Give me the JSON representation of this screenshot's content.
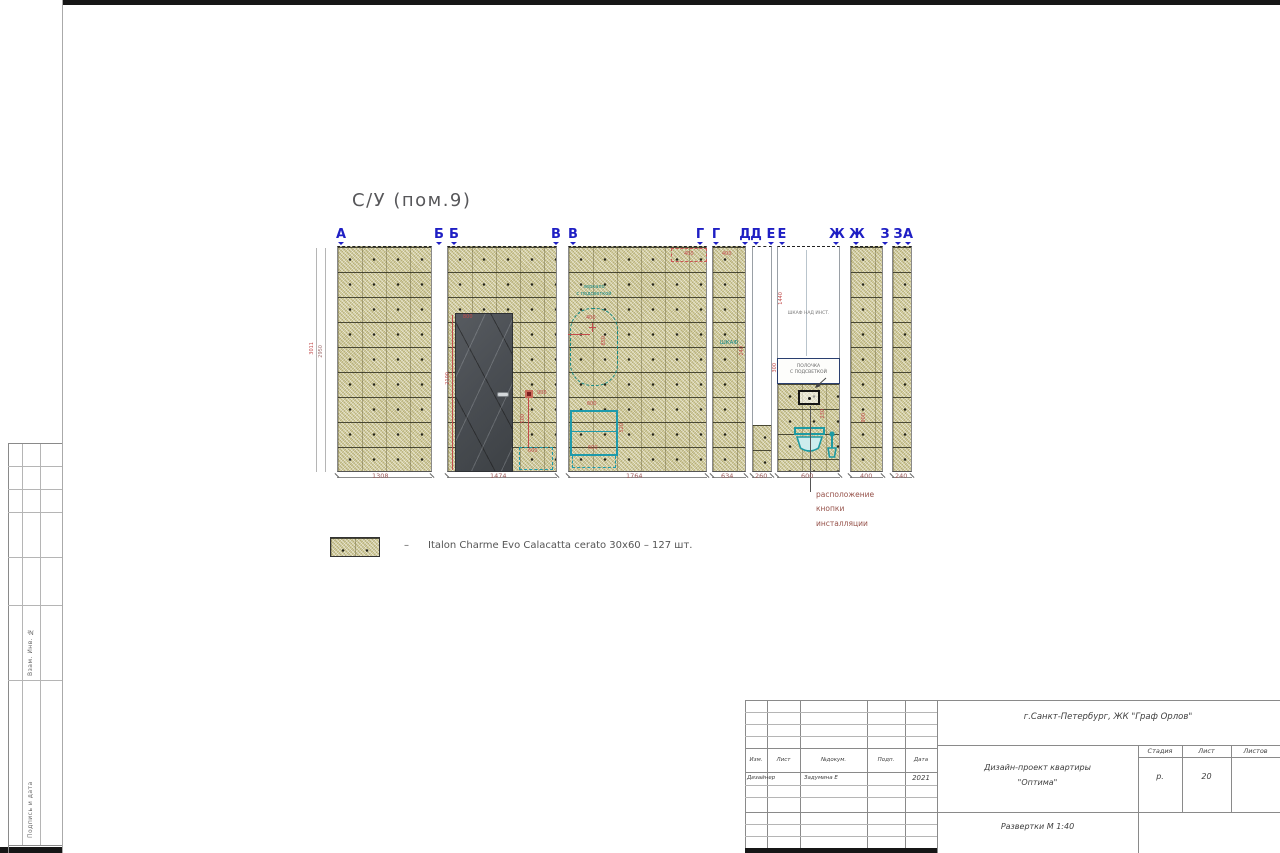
{
  "drawing": {
    "room_title": "С/У (пом.9)",
    "axis_labels": [
      "А",
      "Б",
      "Б",
      "В",
      "В",
      "Г",
      "Г",
      "Д",
      "Д",
      "Е",
      "Е",
      "Ж",
      "Ж",
      "З",
      "З",
      "А"
    ],
    "bottom_dims": [
      "1308",
      "1474",
      "1764",
      "634",
      "260",
      "600",
      "400",
      "240"
    ],
    "height_dims": {
      "outer": "3011",
      "inner": "2950"
    },
    "red_dims": {
      "door_top": "800",
      "door_h": "2100",
      "switch": "900",
      "niche_w": "600",
      "niche_h": "500",
      "mirror_w": "400",
      "mirror_h": "850",
      "cab_top": "600",
      "cab_h": "520",
      "cab_w": "600",
      "vv_top": "400",
      "gg_top": "400",
      "gg_side": "240",
      "inst_h": "1440",
      "shelf_h": "300",
      "btn_h": "230",
      "wall_j": "900"
    },
    "annotations": {
      "mirror_l1": "зеркало",
      "mirror_l2": "с подсветкой",
      "wardrobe": "ШКАФ",
      "inst_cab": "ШКАФ НАД ИНСТ.",
      "shelf_l1": "ПОЛОЧКА",
      "shelf_l2": "С ПОДСВЕТКОЙ",
      "flush_l1": "расположение",
      "flush_l2": "кнопки",
      "flush_l3": "инсталляции"
    }
  },
  "legend": {
    "dash": "–",
    "text": "Italon Charme Evo Calacatta cerato 30x60  –  127 шт."
  },
  "side_stamp": {
    "vzam": "Взам. Инв. №",
    "podpis": "Подпись и дата"
  },
  "title_block": {
    "location": "г.Санкт-Петербург,  ЖК  \"Граф  Орлов\"",
    "columns": [
      "Изм.",
      "Лист",
      "№докум.",
      "Подп.",
      "Дата"
    ],
    "row": {
      "role": "Дизайнер",
      "name": "Задумина Е",
      "date": "2021"
    },
    "project_l1": "Дизайн-проект квартиры",
    "project_l2": "\"Оптима\"",
    "stage_columns": [
      "Стадия",
      "Лист",
      "Листов"
    ],
    "stage": "р.",
    "sheet": "20",
    "sheets": "",
    "doc_name": "Развертки   М 1:40"
  },
  "colors": {
    "axis": "#1f1fc4",
    "dim_red": "#c24b4b",
    "teal": "#1d9aa3",
    "tile": "#d8d3a2"
  }
}
